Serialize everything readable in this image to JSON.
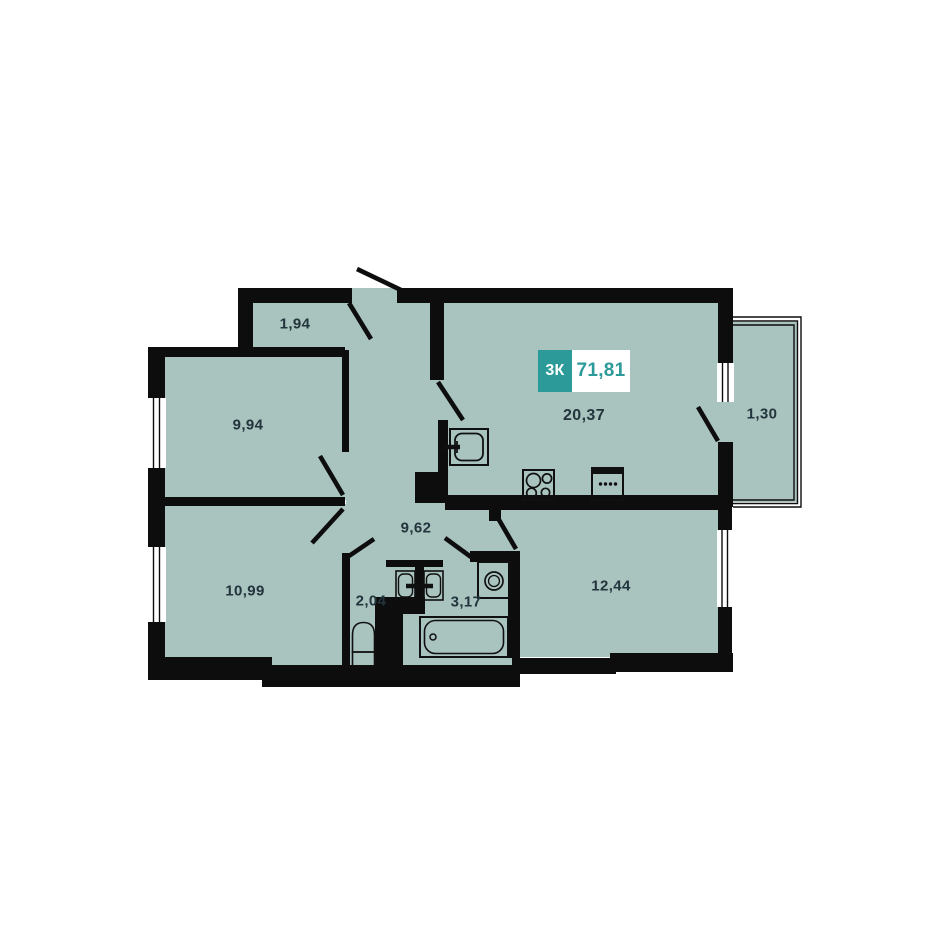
{
  "title": "Apartment floor plan",
  "badge": {
    "type_label": "3К",
    "area_value": "71,81"
  },
  "rooms": {
    "closet": {
      "area": "1,94"
    },
    "bedroom_top": {
      "area": "9,94"
    },
    "kitchen_living": {
      "area": "20,37"
    },
    "balcony": {
      "area": "1,30"
    },
    "hallway": {
      "area": "9,62"
    },
    "bedroom_bottom": {
      "area": "10,99"
    },
    "wc": {
      "area": "2,04"
    },
    "bathroom": {
      "area": "3,17"
    },
    "bedroom_right": {
      "area": "12,44"
    }
  },
  "fixtures": [
    "kitchen-sink",
    "stove",
    "kitchen-cabinet",
    "wash-basin",
    "wash-basin",
    "toilet",
    "bathtub",
    "washing-machine"
  ],
  "colors": {
    "accent": "#2b9a99",
    "floor": "#a9c3bf",
    "wall": "#0d0d0d",
    "label": "#22343c"
  }
}
